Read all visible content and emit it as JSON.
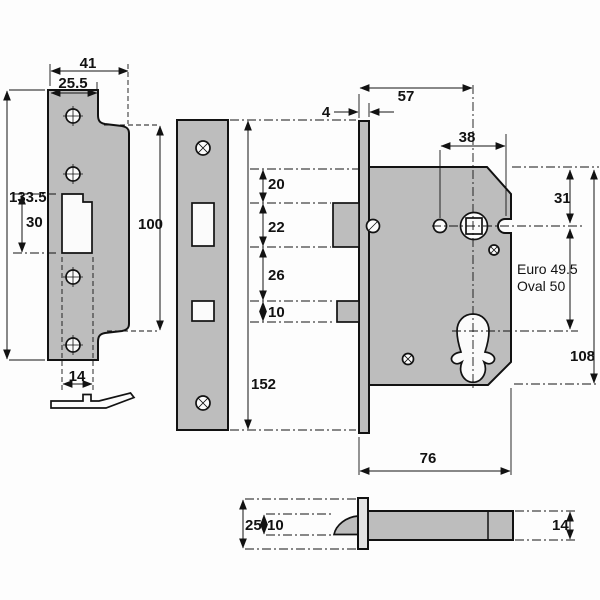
{
  "title": "Mortice sashlock dimensional drawing",
  "colors": {
    "metal": "#bdbdbd",
    "outline": "#121212",
    "background": "#fdfdfd"
  },
  "views": {
    "strike_plate_front": {
      "dims": {
        "overall_width": "41",
        "plate_width": "25.5",
        "overall_height": "133.5",
        "cutout_height": "30",
        "wide_section_height": "100",
        "cutout_width": "14"
      }
    },
    "forend_front": {
      "dims": {
        "length": "152"
      }
    },
    "lock_front": {
      "dims": {
        "top_to_latch": "20",
        "latch_height": "22",
        "latch_to_deadbolt": "26",
        "deadbolt_height": "10",
        "backset": "57",
        "forend_thickness": "4",
        "follower_to_hole": "38",
        "top_to_follower": "31",
        "case_height": "108",
        "case_depth": "76"
      },
      "cylinder_note_line1": "Euro 49.5",
      "cylinder_note_line2": "Oval 50"
    },
    "lock_bottom": {
      "dims": {
        "forend_width": "25",
        "latch_thickness": "10",
        "case_thickness": "14"
      }
    }
  }
}
